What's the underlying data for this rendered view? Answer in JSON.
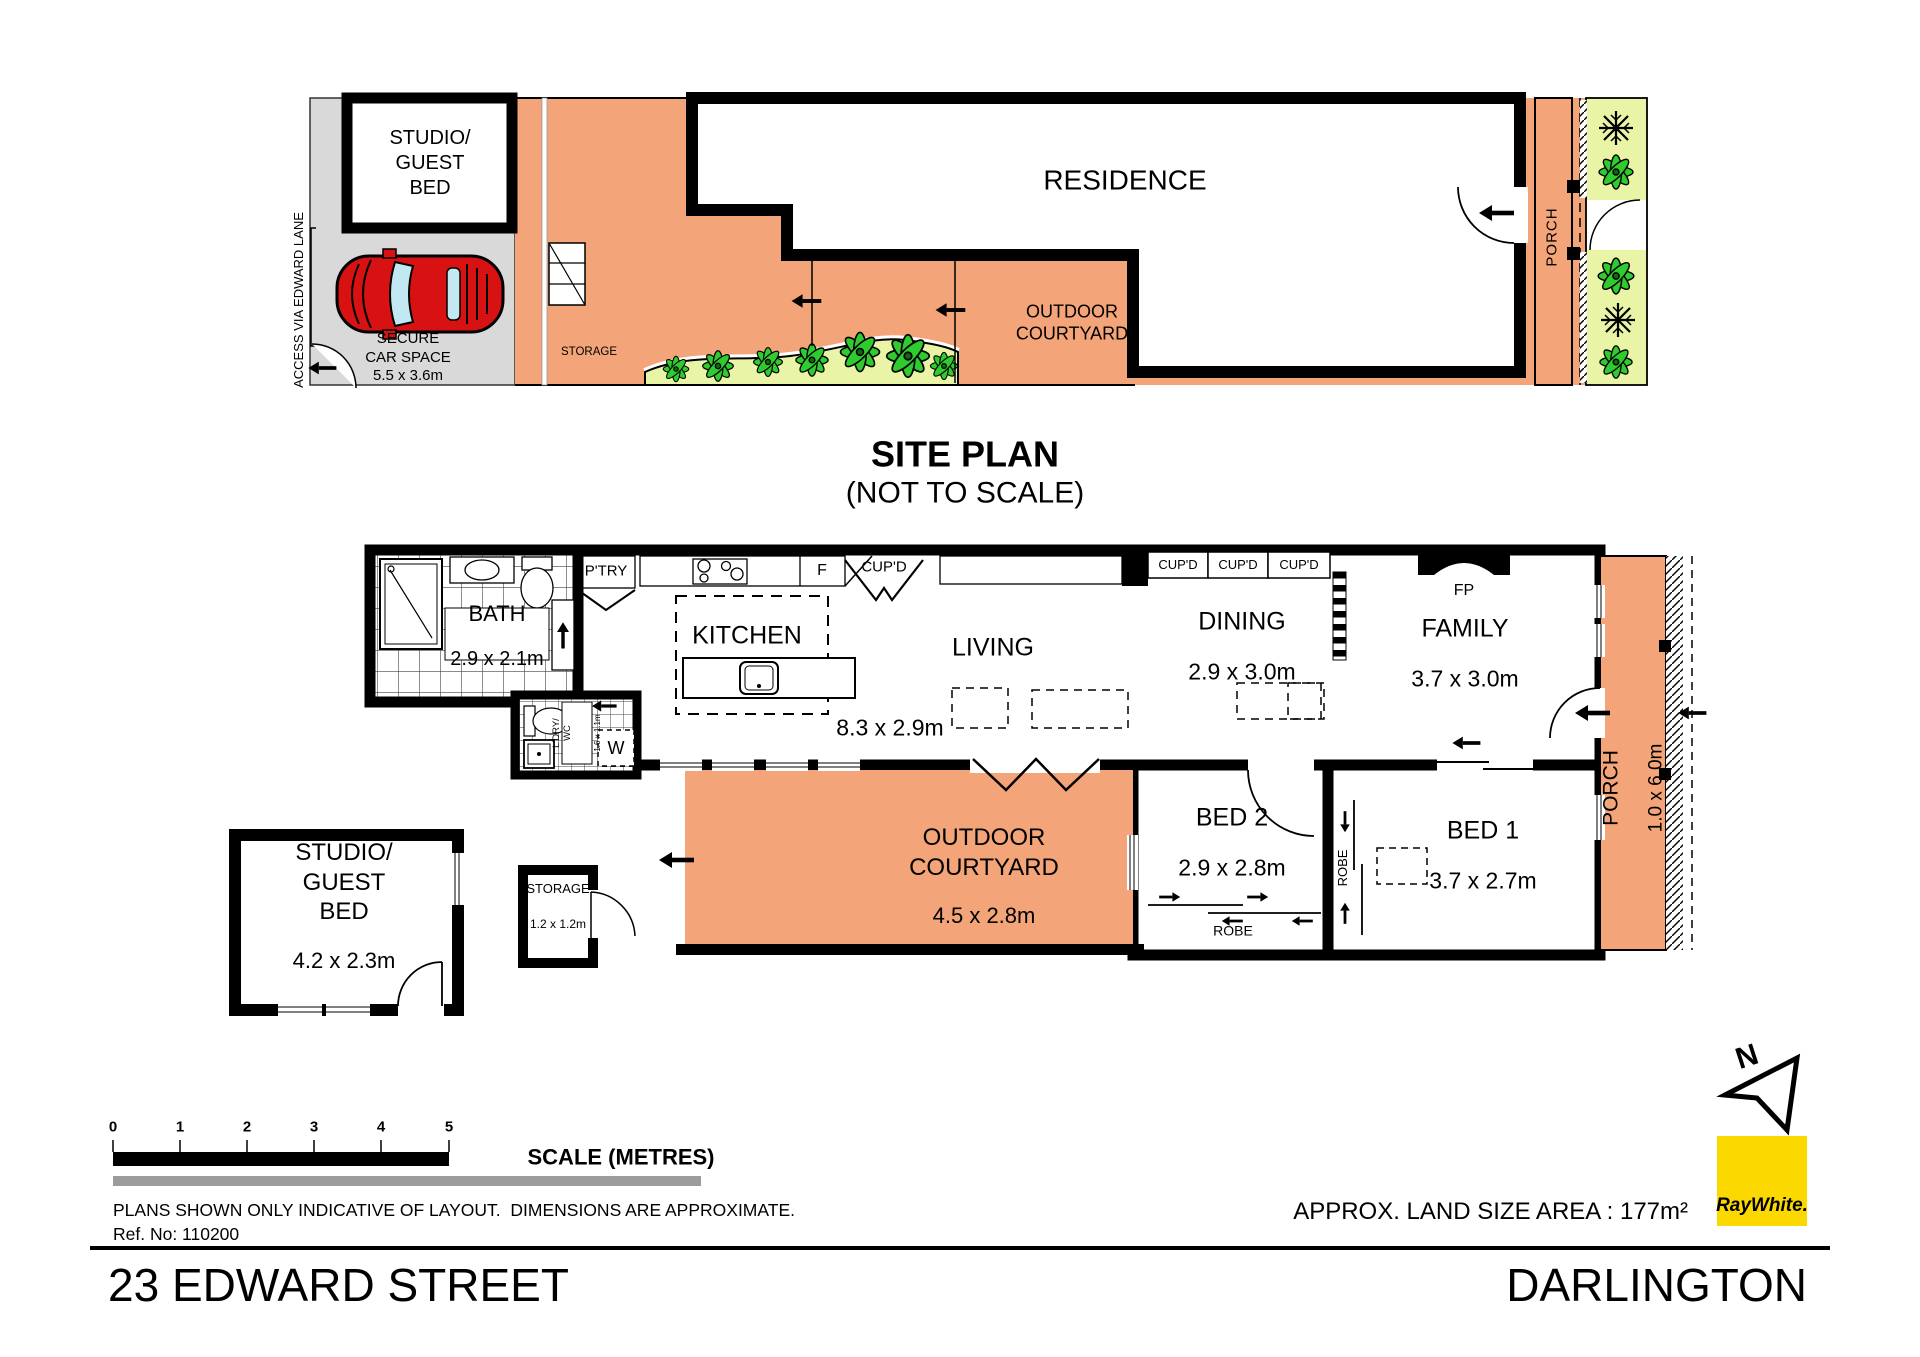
{
  "colors": {
    "outdoor_orange": "#F3A478",
    "garden_green": "#E9F4A6",
    "plant_green": "#2FCB2F",
    "car_red": "#D81212",
    "car_space_grey": "#D9D9D9",
    "ray_white_yellow": "#FBD900",
    "wall_black": "#000000",
    "scale_grey": "#9C9C9C"
  },
  "site_plan": {
    "title": "SITE PLAN",
    "subtitle": "(NOT TO SCALE)",
    "residence": "RESIDENCE",
    "outdoor_courtyard": "OUTDOOR\nCOURTYARD",
    "porch": "PORCH",
    "studio_guest_bed": "STUDIO/\nGUEST\nBED",
    "secure_car_space": "SECURE\nCAR SPACE\n5.5 x 3.6m",
    "access": "ACCESS VIA EDWARD LANE",
    "storage": "STORAGE"
  },
  "floor_plan": {
    "rooms": {
      "bath": "BATH",
      "bath_dims": "2.9 x 2.1m",
      "kitchen": "KITCHEN",
      "living": "LIVING",
      "living_dims": "8.3 x 2.9m",
      "dining": "DINING",
      "dining_dims": "2.9 x 3.0m",
      "family": "FAMILY",
      "family_dims": "3.7 x 3.0m",
      "bed1": "BED 1",
      "bed1_dims": "3.7 x 2.7m",
      "bed2": "BED 2",
      "bed2_dims": "2.9 x 2.8m",
      "courtyard": "OUTDOOR\nCOURTYARD",
      "courtyard_dims": "4.5 x 2.8m",
      "studio": "STUDIO/\nGUEST\nBED",
      "studio_dims": "4.2 x 2.3m",
      "storage": "STORAGE",
      "storage_dims": "1.2 x 1.2m",
      "porch": "PORCH",
      "porch_dims": "1.0 x 6.0m",
      "laundry": "L'DRY/\nWC",
      "laundry_dims": "1.6 x 1.1m"
    },
    "fixtures": {
      "pantry": "P'TRY",
      "fridge": "F",
      "cupboard": "CUP'D",
      "fireplace": "FP",
      "robe": "ROBE",
      "washer": "W"
    }
  },
  "scale_bar": {
    "ticks": [
      "0",
      "1",
      "2",
      "3",
      "4",
      "5"
    ],
    "label": "SCALE (METRES)"
  },
  "footer": {
    "disclaimer": "PLANS SHOWN ONLY INDICATIVE OF LAYOUT.  DIMENSIONS ARE APPROXIMATE.",
    "ref_no": "Ref. No: 110200",
    "land_size": "APPROX. LAND SIZE AREA : 177m²",
    "address": "23 EDWARD STREET",
    "suburb": "DARLINGTON",
    "brand": "RayWhite.",
    "north": "N"
  }
}
